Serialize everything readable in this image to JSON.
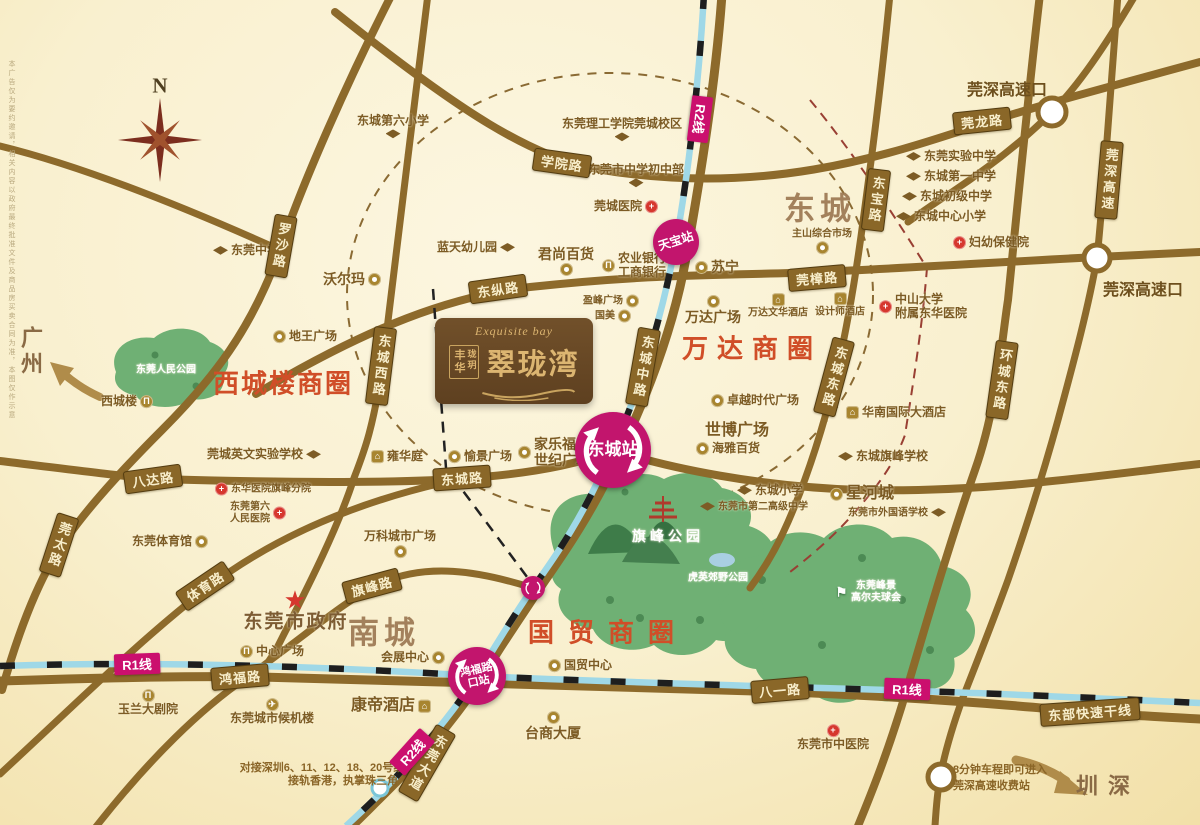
{
  "compass": {
    "north_label": "N"
  },
  "logo": {
    "script": "Exquisite bay",
    "name": "翠珑湾",
    "side_cols": [
      "丰华",
      "珑玥"
    ]
  },
  "cities": [
    {
      "name": "广州",
      "x": 30,
      "y": 352
    },
    {
      "name": "深圳",
      "x": 1101,
      "y": 791
    }
  ],
  "districts": [
    {
      "name": "东城",
      "x": 820,
      "y": 206
    },
    {
      "name": "南城",
      "x": 384,
      "y": 630
    }
  ],
  "business_circles": [
    {
      "name": "西城楼商圈",
      "x": 283,
      "y": 382,
      "ls": 2
    },
    {
      "name": "万达商圈",
      "x": 752,
      "y": 347,
      "ls": 9
    },
    {
      "name": "国贸商圈",
      "x": 608,
      "y": 631,
      "ls": 14
    }
  ],
  "highway_exits": [
    {
      "name": "莞深高速口",
      "x": 1007,
      "y": 88
    },
    {
      "name": "莞深高速口",
      "x": 1143,
      "y": 288
    }
  ],
  "road_labels": [
    {
      "name": "学院路",
      "x": 562,
      "y": 163,
      "rot": 8,
      "v": false
    },
    {
      "name": "莞龙路",
      "x": 982,
      "y": 121,
      "rot": -6,
      "v": false
    },
    {
      "name": "罗沙路",
      "x": 281,
      "y": 246,
      "rot": 10,
      "v": true
    },
    {
      "name": "东纵路",
      "x": 498,
      "y": 289,
      "rot": -8,
      "v": false
    },
    {
      "name": "莞樟路",
      "x": 817,
      "y": 278,
      "rot": -5,
      "v": false
    },
    {
      "name": "东城西路",
      "x": 381,
      "y": 366,
      "rot": 7,
      "v": true
    },
    {
      "name": "东城中路",
      "x": 643,
      "y": 367,
      "rot": 10,
      "v": true
    },
    {
      "name": "东宝路",
      "x": 876,
      "y": 200,
      "rot": 7,
      "v": true
    },
    {
      "name": "莞深高速",
      "x": 1109,
      "y": 180,
      "rot": 5,
      "v": true
    },
    {
      "name": "东城东路",
      "x": 834,
      "y": 377,
      "rot": 15,
      "v": true
    },
    {
      "name": "环城东路",
      "x": 1002,
      "y": 380,
      "rot": 8,
      "v": true
    },
    {
      "name": "八达路",
      "x": 153,
      "y": 479,
      "rot": -8,
      "v": false
    },
    {
      "name": "东城路",
      "x": 462,
      "y": 478,
      "rot": -4,
      "v": false
    },
    {
      "name": "莞太路",
      "x": 59,
      "y": 545,
      "rot": 18,
      "v": true
    },
    {
      "name": "体育路",
      "x": 205,
      "y": 586,
      "rot": -34,
      "v": false
    },
    {
      "name": "旗峰路",
      "x": 372,
      "y": 586,
      "rot": -15,
      "v": false
    },
    {
      "name": "鸿福路",
      "x": 240,
      "y": 677,
      "rot": -5,
      "v": false
    },
    {
      "name": "八一路",
      "x": 780,
      "y": 690,
      "rot": -5,
      "v": false
    },
    {
      "name": "东部快速干线",
      "x": 1090,
      "y": 712,
      "rot": -4,
      "v": false
    },
    {
      "name": "东莞大道",
      "x": 427,
      "y": 763,
      "rot": 30,
      "v": true
    }
  ],
  "metro": {
    "line_labels": [
      {
        "name": "R1线",
        "x": 137,
        "y": 664,
        "rot": -2
      },
      {
        "name": "R1线",
        "x": 907,
        "y": 689,
        "rot": 2
      },
      {
        "name": "R2线",
        "x": 700,
        "y": 119,
        "rot": 97
      },
      {
        "name": "R2线",
        "x": 412,
        "y": 752,
        "rot": -48
      }
    ],
    "stations": [
      {
        "name": "天宝站",
        "x": 676,
        "y": 242,
        "d": 46,
        "rot": -18,
        "ring": false,
        "fs": 12
      },
      {
        "name": "东城站",
        "x": 613,
        "y": 450,
        "d": 76,
        "rot": 0,
        "ring": true,
        "fs": 17
      },
      {
        "name": "鸿福路\n口站",
        "x": 477,
        "y": 676,
        "d": 58,
        "rot": -12,
        "ring": true,
        "fs": 11
      },
      {
        "name": "",
        "x": 533,
        "y": 588,
        "d": 24,
        "rot": 0,
        "ring": true,
        "fs": 9
      }
    ]
  },
  "pois": [
    {
      "name": "东城第六小学",
      "x": 393,
      "y": 127,
      "icon": "school",
      "ipos": "below"
    },
    {
      "name": "东莞理工学院莞城校区",
      "x": 622,
      "y": 130,
      "icon": "school",
      "ipos": "below"
    },
    {
      "name": "东莞市中学初中部",
      "x": 636,
      "y": 176,
      "icon": "school",
      "ipos": "below"
    },
    {
      "name": "莞城医院",
      "x": 626,
      "y": 207,
      "icon": "hospital",
      "ipos": "right"
    },
    {
      "name": "东莞中学",
      "x": 246,
      "y": 251,
      "icon": "school",
      "ipos": "left"
    },
    {
      "name": "沃尔玛",
      "x": 352,
      "y": 279,
      "icon": "shop",
      "ipos": "right",
      "size": "lg"
    },
    {
      "name": "蓝天幼儿园",
      "x": 476,
      "y": 248,
      "icon": "school",
      "ipos": "right"
    },
    {
      "name": "君尚百货",
      "x": 566,
      "y": 261,
      "icon": "shop",
      "ipos": "below",
      "size": "lg"
    },
    {
      "name": "农业银行\n工商银行",
      "x": 634,
      "y": 266,
      "icon": "bank",
      "ipos": "left"
    },
    {
      "name": "苏宁",
      "x": 717,
      "y": 267,
      "icon": "shop",
      "ipos": "left",
      "size": "lg"
    },
    {
      "name": "主山综合市场",
      "x": 822,
      "y": 241,
      "icon": "shop",
      "ipos": "below",
      "size": "sm"
    },
    {
      "name": "东莞实验中学",
      "x": 951,
      "y": 157,
      "icon": "school",
      "ipos": "left"
    },
    {
      "name": "东城第一中学",
      "x": 951,
      "y": 177,
      "icon": "school",
      "ipos": "left"
    },
    {
      "name": "东城初级中学",
      "x": 947,
      "y": 197,
      "icon": "school",
      "ipos": "left"
    },
    {
      "name": "东城中心小学",
      "x": 941,
      "y": 217,
      "icon": "school",
      "ipos": "left"
    },
    {
      "name": "妇幼保健院",
      "x": 991,
      "y": 243,
      "icon": "hospital",
      "ipos": "left"
    },
    {
      "name": "地王广场",
      "x": 305,
      "y": 337,
      "icon": "shop",
      "ipos": "left"
    },
    {
      "name": "西城楼",
      "x": 127,
      "y": 402,
      "icon": "bank",
      "ipos": "right"
    },
    {
      "name": "盈峰广场",
      "x": 611,
      "y": 301,
      "icon": "shop",
      "ipos": "right",
      "size": "sm"
    },
    {
      "name": "国美",
      "x": 613,
      "y": 316,
      "icon": "shop",
      "ipos": "right",
      "size": "sm"
    },
    {
      "name": "万达广场",
      "x": 713,
      "y": 310,
      "icon": "shop",
      "ipos": "above",
      "size": "lg"
    },
    {
      "name": "万达文华酒店",
      "x": 778,
      "y": 306,
      "icon": "hotel",
      "ipos": "above",
      "size": "sm"
    },
    {
      "name": "设计师酒店",
      "x": 840,
      "y": 305,
      "icon": "hotel",
      "ipos": "above",
      "size": "sm"
    },
    {
      "name": "中山大学\n附属东华医院",
      "x": 923,
      "y": 307,
      "icon": "hospital",
      "ipos": "left"
    },
    {
      "name": "卓越时代广场",
      "x": 755,
      "y": 401,
      "icon": "shop",
      "ipos": "left"
    },
    {
      "name": "世博广场",
      "x": 737,
      "y": 431,
      "icon": "",
      "ipos": "none",
      "size": "xl"
    },
    {
      "name": "海雅百货",
      "x": 728,
      "y": 449,
      "icon": "shop",
      "ipos": "left"
    },
    {
      "name": "华南国际大酒店",
      "x": 896,
      "y": 413,
      "icon": "hotel",
      "ipos": "left"
    },
    {
      "name": "东城旗峰学校",
      "x": 883,
      "y": 457,
      "icon": "school",
      "ipos": "left"
    },
    {
      "name": "雍华庭",
      "x": 397,
      "y": 457,
      "icon": "hotel",
      "ipos": "left"
    },
    {
      "name": "愉景广场",
      "x": 480,
      "y": 457,
      "icon": "shop",
      "ipos": "left"
    },
    {
      "name": "家乐福\n世纪广场",
      "x": 554,
      "y": 452,
      "icon": "shop",
      "ipos": "left",
      "size": "lg"
    },
    {
      "name": "莞城英文实验学校",
      "x": 264,
      "y": 455,
      "icon": "school",
      "ipos": "right"
    },
    {
      "name": "东华医院旗峰分院",
      "x": 263,
      "y": 489,
      "icon": "hospital",
      "ipos": "left",
      "size": "sm"
    },
    {
      "name": "东莞第六\n人民医院",
      "x": 258,
      "y": 513,
      "icon": "hospital",
      "ipos": "right",
      "size": "sm"
    },
    {
      "name": "东莞体育馆",
      "x": 170,
      "y": 542,
      "icon": "gym",
      "ipos": "right"
    },
    {
      "name": "万科城市广场",
      "x": 400,
      "y": 544,
      "icon": "shop",
      "ipos": "below"
    },
    {
      "name": "东城小学",
      "x": 770,
      "y": 491,
      "icon": "school",
      "ipos": "left"
    },
    {
      "name": "东莞市第二高级中学",
      "x": 754,
      "y": 507,
      "icon": "school",
      "ipos": "left",
      "size": "sm"
    },
    {
      "name": "星河城",
      "x": 862,
      "y": 494,
      "icon": "shop",
      "ipos": "left",
      "size": "xl"
    },
    {
      "name": "东莞市外国语学校",
      "x": 897,
      "y": 513,
      "icon": "school",
      "ipos": "right",
      "size": "sm"
    },
    {
      "name": "东莞市政府",
      "x": 296,
      "y": 612,
      "icon": "star",
      "ipos": "above",
      "size": "gov"
    },
    {
      "name": "中心广场",
      "x": 272,
      "y": 652,
      "icon": "bank",
      "ipos": "left"
    },
    {
      "name": "会展中心",
      "x": 413,
      "y": 658,
      "icon": "shop",
      "ipos": "right"
    },
    {
      "name": "国贸中心",
      "x": 580,
      "y": 666,
      "icon": "shop",
      "ipos": "left"
    },
    {
      "name": "台商大厦",
      "x": 553,
      "y": 726,
      "icon": "shop",
      "ipos": "above",
      "size": "lg"
    },
    {
      "name": "玉兰大剧院",
      "x": 148,
      "y": 703,
      "icon": "bank",
      "ipos": "above"
    },
    {
      "name": "东莞城市候机楼",
      "x": 272,
      "y": 712,
      "icon": "plane",
      "ipos": "above"
    },
    {
      "name": "康帝酒店",
      "x": 391,
      "y": 706,
      "icon": "hotel",
      "ipos": "right",
      "size": "xl"
    },
    {
      "name": "东莞市中医院",
      "x": 833,
      "y": 738,
      "icon": "hospital",
      "ipos": "above"
    }
  ],
  "park_labels": [
    {
      "name": "东莞人民公园",
      "x": 166,
      "y": 370,
      "size": "sm"
    },
    {
      "name": "旗峰公园",
      "x": 668,
      "y": 536,
      "size": "lg"
    },
    {
      "name": "虎英郊野公园",
      "x": 718,
      "y": 578,
      "size": "sm"
    },
    {
      "name": "东莞峰景\n高尔夫球会",
      "x": 868,
      "y": 592,
      "size": "sm",
      "icon": "golf",
      "ipos": "left"
    }
  ],
  "notes": [
    {
      "text": "对接深圳6、11、12、18、20号线",
      "x": 322,
      "y": 767
    },
    {
      "text": "接轨香港，执掌珠三角",
      "x": 343,
      "y": 780
    },
    {
      "text": "8分钟车程即可进入\n莞深高速收费站",
      "x": 1000,
      "y": 777
    }
  ],
  "disclaimer": "本广告仅为要约邀请，相关内容以政府最终批准文件及商品房买卖合同为准，本图仅作示意",
  "colors": {
    "road": "#8d6a2b",
    "metro_blue": "#9fd8e7",
    "station_pink": "#c2156d",
    "business_red": "#d04e28",
    "park_green": "#6fb074",
    "district_brown": "#a3815c"
  }
}
